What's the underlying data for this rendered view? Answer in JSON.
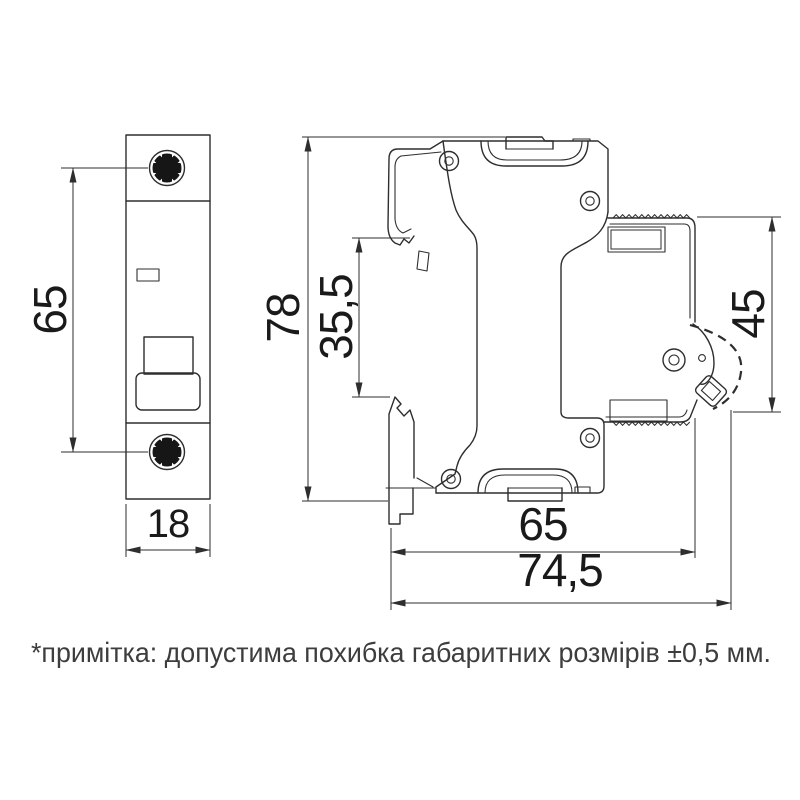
{
  "drawing": {
    "note": "*примітка: допустима похибка габаритних розмірів ±0,5 мм.",
    "dimensions": {
      "front_height": "65",
      "front_width": "18",
      "side_height": "78",
      "din_recess": "35,5",
      "terminal_side": "45",
      "base_width": "65",
      "total_depth": "74,5"
    },
    "colors": {
      "line": "#2e2e2e",
      "text": "#1a1a1a",
      "background": "#ffffff"
    }
  }
}
